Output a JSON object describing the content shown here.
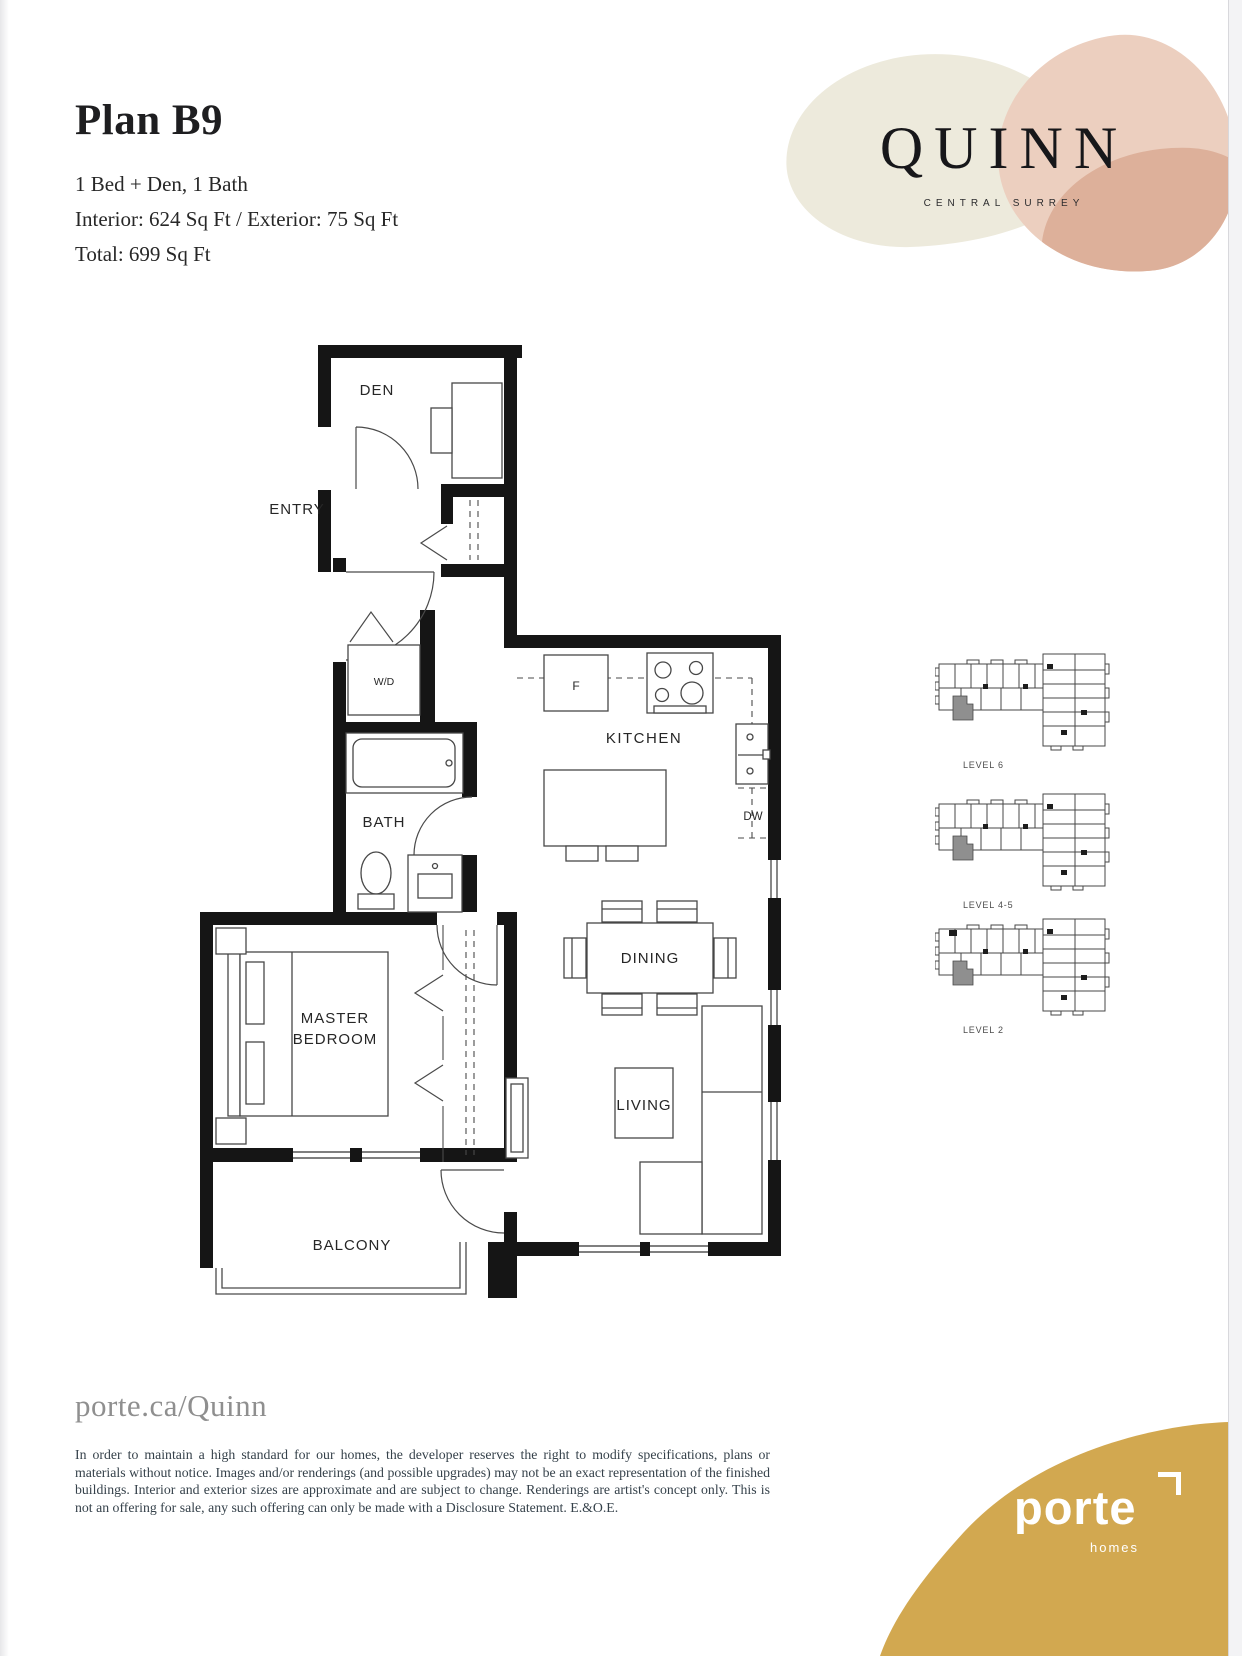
{
  "header": {
    "title": "Plan B9",
    "configuration": "1 Bed + Den, 1 Bath",
    "area_line": "Interior: 624 Sq Ft  /  Exterior: 75 Sq Ft",
    "total_line": "Total: 699 Sq Ft"
  },
  "brand": {
    "name": "QUINN",
    "tagline": "CENTRAL SURREY",
    "colors": {
      "cream": "#edeadc",
      "blush": "#eccfbf",
      "salmon": "#ddb09a"
    }
  },
  "floorplan": {
    "labels": {
      "den": "DEN",
      "entry": "ENTRY",
      "washer_dryer": "W/D",
      "bath": "BATH",
      "kitchen": "KITCHEN",
      "fridge": "F",
      "dishwasher": "DW",
      "dining": "DINING",
      "living": "LIVING",
      "master_line1": "MASTER",
      "master_line2": "BEDROOM",
      "balcony": "BALCONY"
    }
  },
  "keyplans": [
    {
      "label": "LEVEL 6"
    },
    {
      "label": "LEVEL 4-5"
    },
    {
      "label": "LEVEL 2"
    }
  ],
  "footer": {
    "website": "porte.ca/Quinn",
    "disclaimer": "In order to maintain a high standard for our homes, the developer reserves the right to modify specifications, plans or materials without notice. Images and/or renderings (and possible upgrades) may not be an exact representation of the finished buildings. Interior and exterior sizes are approximate and are subject to change. Renderings are artist's concept only. This is not an offering for sale, any such offering can only be made with a Disclosure Statement. E.&O.E.",
    "logo": {
      "wordmark": "porte",
      "sub": "homes",
      "color": "#d2a850"
    }
  }
}
